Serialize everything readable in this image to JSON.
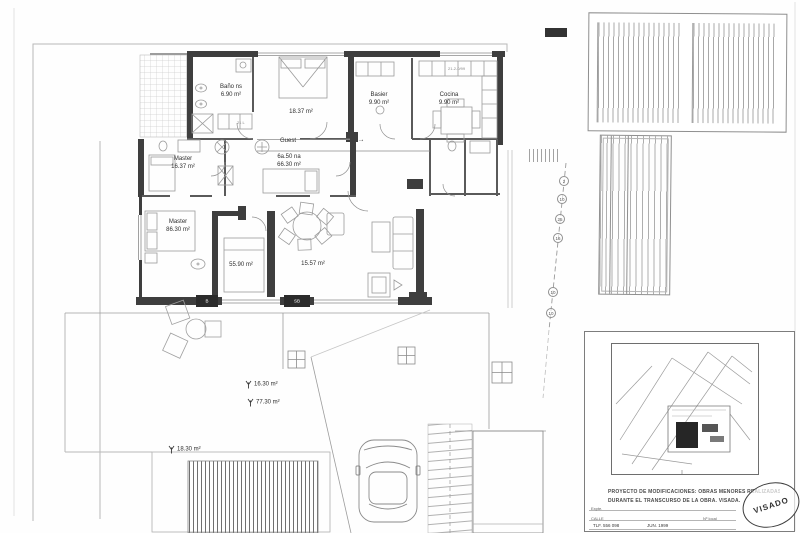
{
  "drawing": {
    "rooms": [
      {
        "label": "Baño ns",
        "area": "6.90 m²"
      },
      {
        "label": "",
        "area": "18.37 m²"
      },
      {
        "label": "Basier",
        "area": "9.90 m²"
      },
      {
        "label": "Cocina",
        "area": "9.90 m²"
      },
      {
        "label": "Master",
        "area": "16.37 m²"
      },
      {
        "label": "Guest",
        "area": ""
      },
      {
        "label": "6a.50 na",
        "area": "66.30 m²"
      },
      {
        "label": "Master",
        "area": "86.30 m²"
      },
      {
        "label": "",
        "area": "55.90 m²"
      },
      {
        "label": "",
        "area": "15.57 m²"
      }
    ],
    "guest_arrow": "→",
    "outdoor_areas": [
      {
        "area": "16.30 m²"
      },
      {
        "area": "77.30 m²"
      },
      {
        "area": "18.30 m²"
      }
    ],
    "wall_tags": [
      "B",
      "SB"
    ],
    "plan_notes": {
      "closet": "21 L",
      "kitchen": "21-2-0/99"
    },
    "boundary_markers": [
      "2",
      "10",
      "25",
      "16",
      "10",
      "10"
    ]
  },
  "titleblock": {
    "project_line1": "PROYECTO DE MODIFICACIONES: OBRAS MENORES REALIZADAS",
    "project_line2": "DURANTE EL TRANSCURSO DE LA OBRA. VISADA.",
    "stamp": "VISADO",
    "form": {
      "row1": "Expte.",
      "row2_left": "CALLE",
      "row2_right": "Nº local",
      "row3_left": "TLF. 556 098",
      "row3_right": "JUN. 1999"
    }
  },
  "colors": {
    "wall": "#3e3e3e",
    "furniture_line": "#9b9b9b",
    "boundary": "#b8b8b8",
    "text": "#2e2e2e"
  }
}
